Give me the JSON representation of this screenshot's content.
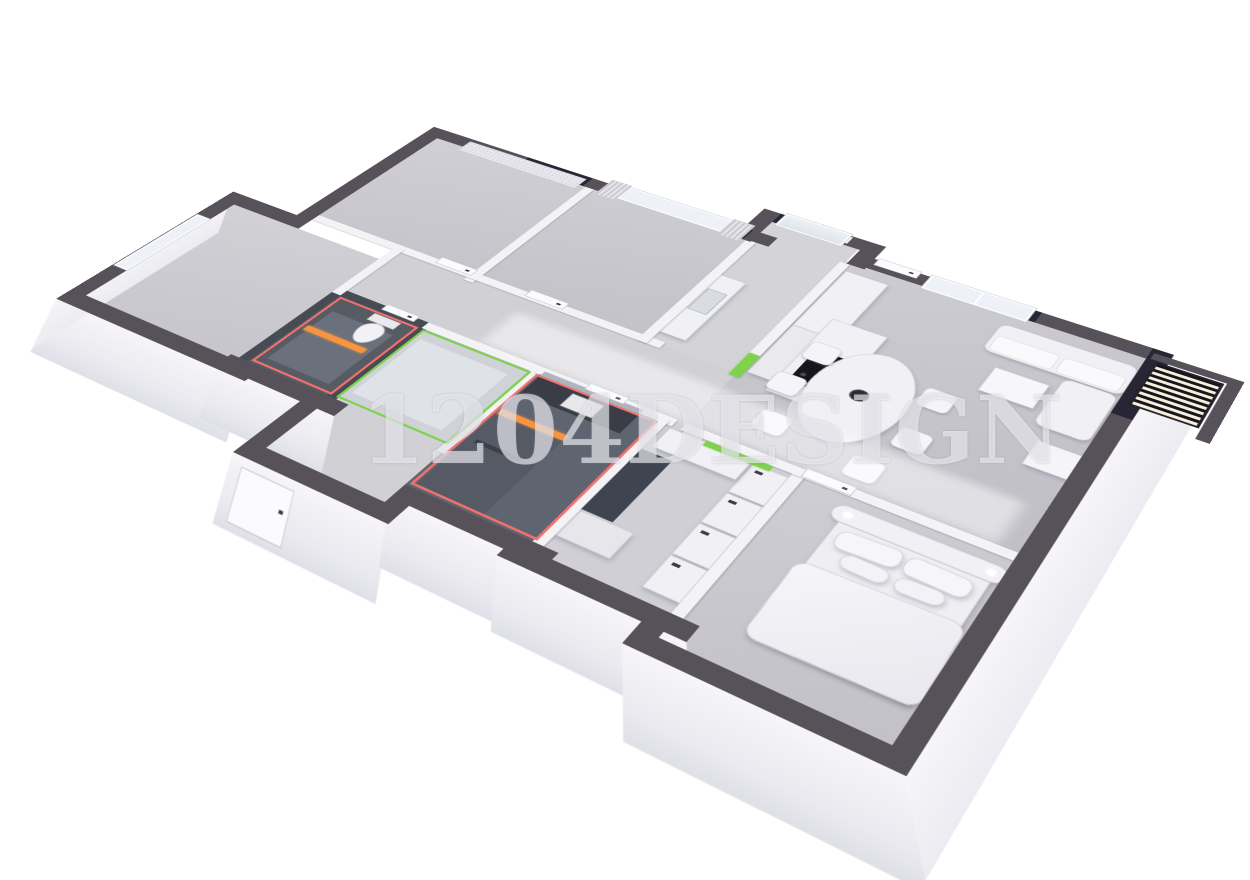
{
  "watermark": {
    "text": "1204DESIGN"
  },
  "palette": {
    "background": "#ffffff",
    "exterior_wall": "#57515a",
    "exterior_wall_dark": "#272634",
    "interior_wall": "#f3f3f6",
    "bathroom_wall": "#474b54",
    "floor": "#c9c8ce",
    "accent_red": "#f4716d",
    "accent_green": "#7fd24c",
    "accent_orange": "#f79440"
  },
  "rooms": [
    {
      "id": "bedroom-top-left",
      "highlight": "none",
      "features": [
        "roman-shade-window"
      ]
    },
    {
      "id": "bedroom-top-middle",
      "highlight": "none",
      "features": [
        "curtained-window"
      ]
    },
    {
      "id": "entry-hall",
      "highlight": "none",
      "features": [
        "glass-block-window",
        "counter-with-sink",
        "entry-door"
      ]
    },
    {
      "id": "living-kitchen",
      "highlight": "none",
      "features": [
        "window",
        "kitchen-island-cooktop",
        "tall-cabinets",
        "dining-set",
        "sofa-set",
        "louver-vent"
      ]
    },
    {
      "id": "bedroom-left",
      "highlight": "none",
      "features": [
        "side-window"
      ]
    },
    {
      "id": "corridor",
      "highlight": "none",
      "features": [
        "two-doors"
      ]
    },
    {
      "id": "wc",
      "highlight": "red",
      "features": [
        "toilet",
        "orange-partition"
      ]
    },
    {
      "id": "utility-room",
      "highlight": "green",
      "features": []
    },
    {
      "id": "south-corridor",
      "highlight": "none",
      "features": [
        "exterior-door"
      ]
    },
    {
      "id": "bathroom",
      "highlight": "red",
      "features": [
        "vanity-sink",
        "mirror",
        "shower",
        "orange-partition"
      ]
    },
    {
      "id": "walk-in-closet",
      "highlight": "green-accents",
      "features": [
        "wardrobe-units",
        "green-topped-cabinet"
      ]
    },
    {
      "id": "master-bedroom",
      "highlight": "none",
      "features": [
        "double-bed",
        "headboard-lamps",
        "door"
      ]
    }
  ],
  "furniture": [
    "roman-shade",
    "curtains",
    "glass-block-window",
    "kitchen-island",
    "cooktop",
    "kitchen-cabinets",
    "dining-table",
    "dining-chairs",
    "flower-vase",
    "sofa",
    "chaise-lounge",
    "coffee-table",
    "ottoman",
    "double-bed",
    "pillows",
    "duvet",
    "toilet",
    "vanity-counter",
    "sink",
    "mirror",
    "shower",
    "wardrobes",
    "louver-vent",
    "interior-doors"
  ]
}
